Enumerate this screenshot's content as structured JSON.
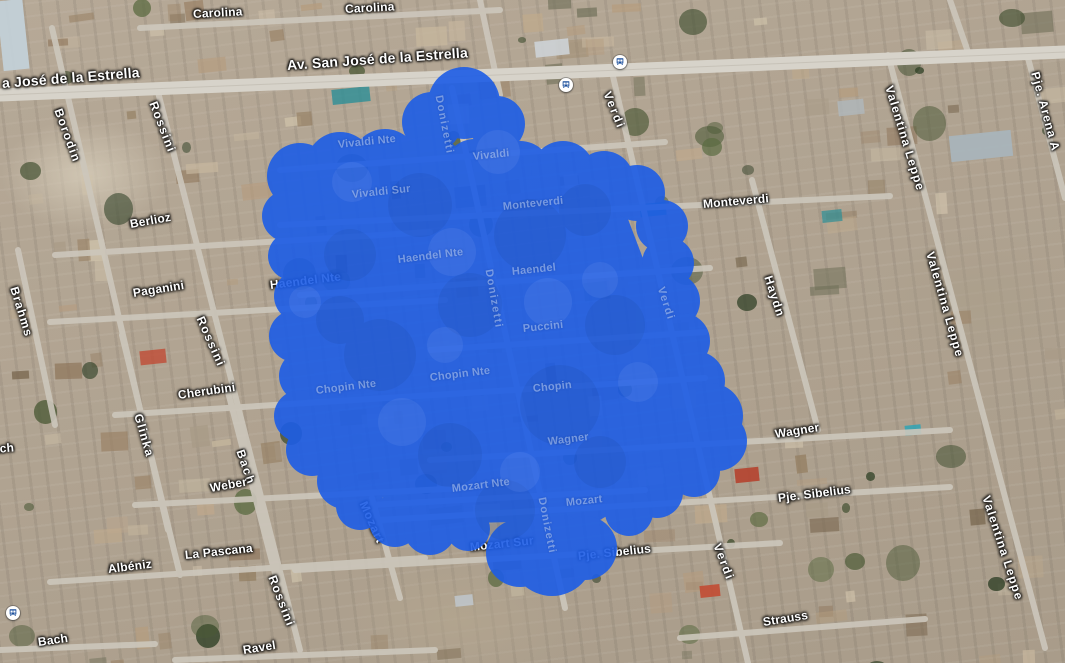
{
  "map": {
    "type_label": "satellite",
    "road_labels": [
      {
        "text": "Carolina",
        "x": 193,
        "y": 8,
        "rot": -3
      },
      {
        "text": "Carolina",
        "x": 345,
        "y": 3,
        "rot": -3
      },
      {
        "text": "a José de la Estrella",
        "x": 2,
        "y": 76,
        "rot": -4.5,
        "size": 14
      },
      {
        "text": "Av. San José de la Estrella",
        "x": 287,
        "y": 58,
        "rot": -4,
        "size": 14,
        "layer": "above"
      },
      {
        "text": "Verdi",
        "x": 607,
        "y": 86,
        "rot": 68,
        "ls": 2
      },
      {
        "text": "Borodin",
        "x": 58,
        "y": 103,
        "rot": 70,
        "ls": 1.5
      },
      {
        "text": "Rossini",
        "x": 153,
        "y": 96,
        "rot": 69,
        "ls": 1.5
      },
      {
        "text": "Pje. Arena A",
        "x": 1035,
        "y": 66,
        "rot": 75,
        "ls": 1
      },
      {
        "text": "Valentina Leppe",
        "x": 889,
        "y": 80,
        "rot": 73,
        "ls": 1.2
      },
      {
        "text": "Berlioz",
        "x": 130,
        "y": 218,
        "rot": -10
      },
      {
        "text": "Monteverdi",
        "x": 703,
        "y": 198,
        "rot": -5
      },
      {
        "text": "Haydn",
        "x": 768,
        "y": 270,
        "rot": 72,
        "ls": 1.2
      },
      {
        "text": "Valentina Leppe",
        "x": 930,
        "y": 246,
        "rot": 74,
        "ls": 1.2
      },
      {
        "text": "Brahms",
        "x": 14,
        "y": 281,
        "rot": 73,
        "ls": 1.2
      },
      {
        "text": "Paganini",
        "x": 133,
        "y": 287,
        "rot": -9
      },
      {
        "text": "Haendel Nte",
        "x": 270,
        "y": 279,
        "rot": -7
      },
      {
        "text": "Rossini",
        "x": 200,
        "y": 311,
        "rot": 66,
        "ls": 1.5
      },
      {
        "text": "Cherubini",
        "x": 178,
        "y": 389,
        "rot": -8
      },
      {
        "text": "Glinka",
        "x": 138,
        "y": 408,
        "rot": 74,
        "ls": 1.3
      },
      {
        "text": "Bach",
        "x": 240,
        "y": 444,
        "rot": 71,
        "ls": 1.8
      },
      {
        "text": "Bach",
        "x": -16,
        "y": 444,
        "rot": -5
      },
      {
        "text": "Weber",
        "x": 210,
        "y": 482,
        "rot": -10
      },
      {
        "text": "Wagner",
        "x": 775,
        "y": 428,
        "rot": -9
      },
      {
        "text": "Pje. Sibelius",
        "x": 778,
        "y": 492,
        "rot": -7
      },
      {
        "text": "Verdi",
        "x": 717,
        "y": 538,
        "rot": 69,
        "ls": 1.8
      },
      {
        "text": "Valentina Leppe",
        "x": 986,
        "y": 490,
        "rot": 72,
        "ls": 1.2
      },
      {
        "text": "Albéniz",
        "x": 108,
        "y": 563,
        "rot": -7
      },
      {
        "text": "La Pascana",
        "x": 185,
        "y": 549,
        "rot": -6
      },
      {
        "text": "Rossini",
        "x": 272,
        "y": 570,
        "rot": 69,
        "ls": 1.5
      },
      {
        "text": "Mozart",
        "x": 363,
        "y": 496,
        "rot": 66,
        "ls": 1
      },
      {
        "text": "Mozart Sur",
        "x": 470,
        "y": 541,
        "rot": -6
      },
      {
        "text": "Pje. Sibelius",
        "x": 578,
        "y": 550,
        "rot": -6
      },
      {
        "text": "Strauss",
        "x": 763,
        "y": 616,
        "rot": -9
      },
      {
        "text": "Bach",
        "x": 38,
        "y": 636,
        "rot": -8
      },
      {
        "text": "Ravel",
        "x": 243,
        "y": 644,
        "rot": -9
      }
    ],
    "transit_stops": [
      {
        "x": 613,
        "y": 55
      },
      {
        "x": 559,
        "y": 78
      },
      {
        "x": 6,
        "y": 606
      }
    ]
  },
  "overlay": {
    "color": "#1d5de6",
    "opacity": 0.9,
    "faint_labels": [
      {
        "text": "Donizetti",
        "x": 438,
        "y": 90,
        "rot": 79,
        "ls": 1.5
      },
      {
        "text": "Vivaldi Nte",
        "x": 338,
        "y": 140,
        "rot": -6
      },
      {
        "text": "Vivaldi",
        "x": 473,
        "y": 152,
        "rot": -6
      },
      {
        "text": "Vivaldi Sur",
        "x": 352,
        "y": 190,
        "rot": -6
      },
      {
        "text": "Monteverdi",
        "x": 503,
        "y": 202,
        "rot": -6
      },
      {
        "text": "Haendel Nte",
        "x": 398,
        "y": 255,
        "rot": -7
      },
      {
        "text": "Haendel",
        "x": 512,
        "y": 267,
        "rot": -6
      },
      {
        "text": "Donizetti",
        "x": 488,
        "y": 264,
        "rot": 80,
        "ls": 1.5
      },
      {
        "text": "Puccini",
        "x": 523,
        "y": 324,
        "rot": -6
      },
      {
        "text": "Verdi",
        "x": 660,
        "y": 282,
        "rot": 72,
        "ls": 1.5
      },
      {
        "text": "Chopin Nte",
        "x": 316,
        "y": 386,
        "rot": -7
      },
      {
        "text": "Chopin Nte",
        "x": 430,
        "y": 373,
        "rot": -7
      },
      {
        "text": "Chopin",
        "x": 533,
        "y": 384,
        "rot": -6
      },
      {
        "text": "Wagner",
        "x": 548,
        "y": 437,
        "rot": -7
      },
      {
        "text": "Mozart Nte",
        "x": 452,
        "y": 484,
        "rot": -7
      },
      {
        "text": "Mozart",
        "x": 566,
        "y": 498,
        "rot": -6
      },
      {
        "text": "Donizetti",
        "x": 541,
        "y": 492,
        "rot": 79,
        "ls": 1.2
      }
    ]
  }
}
